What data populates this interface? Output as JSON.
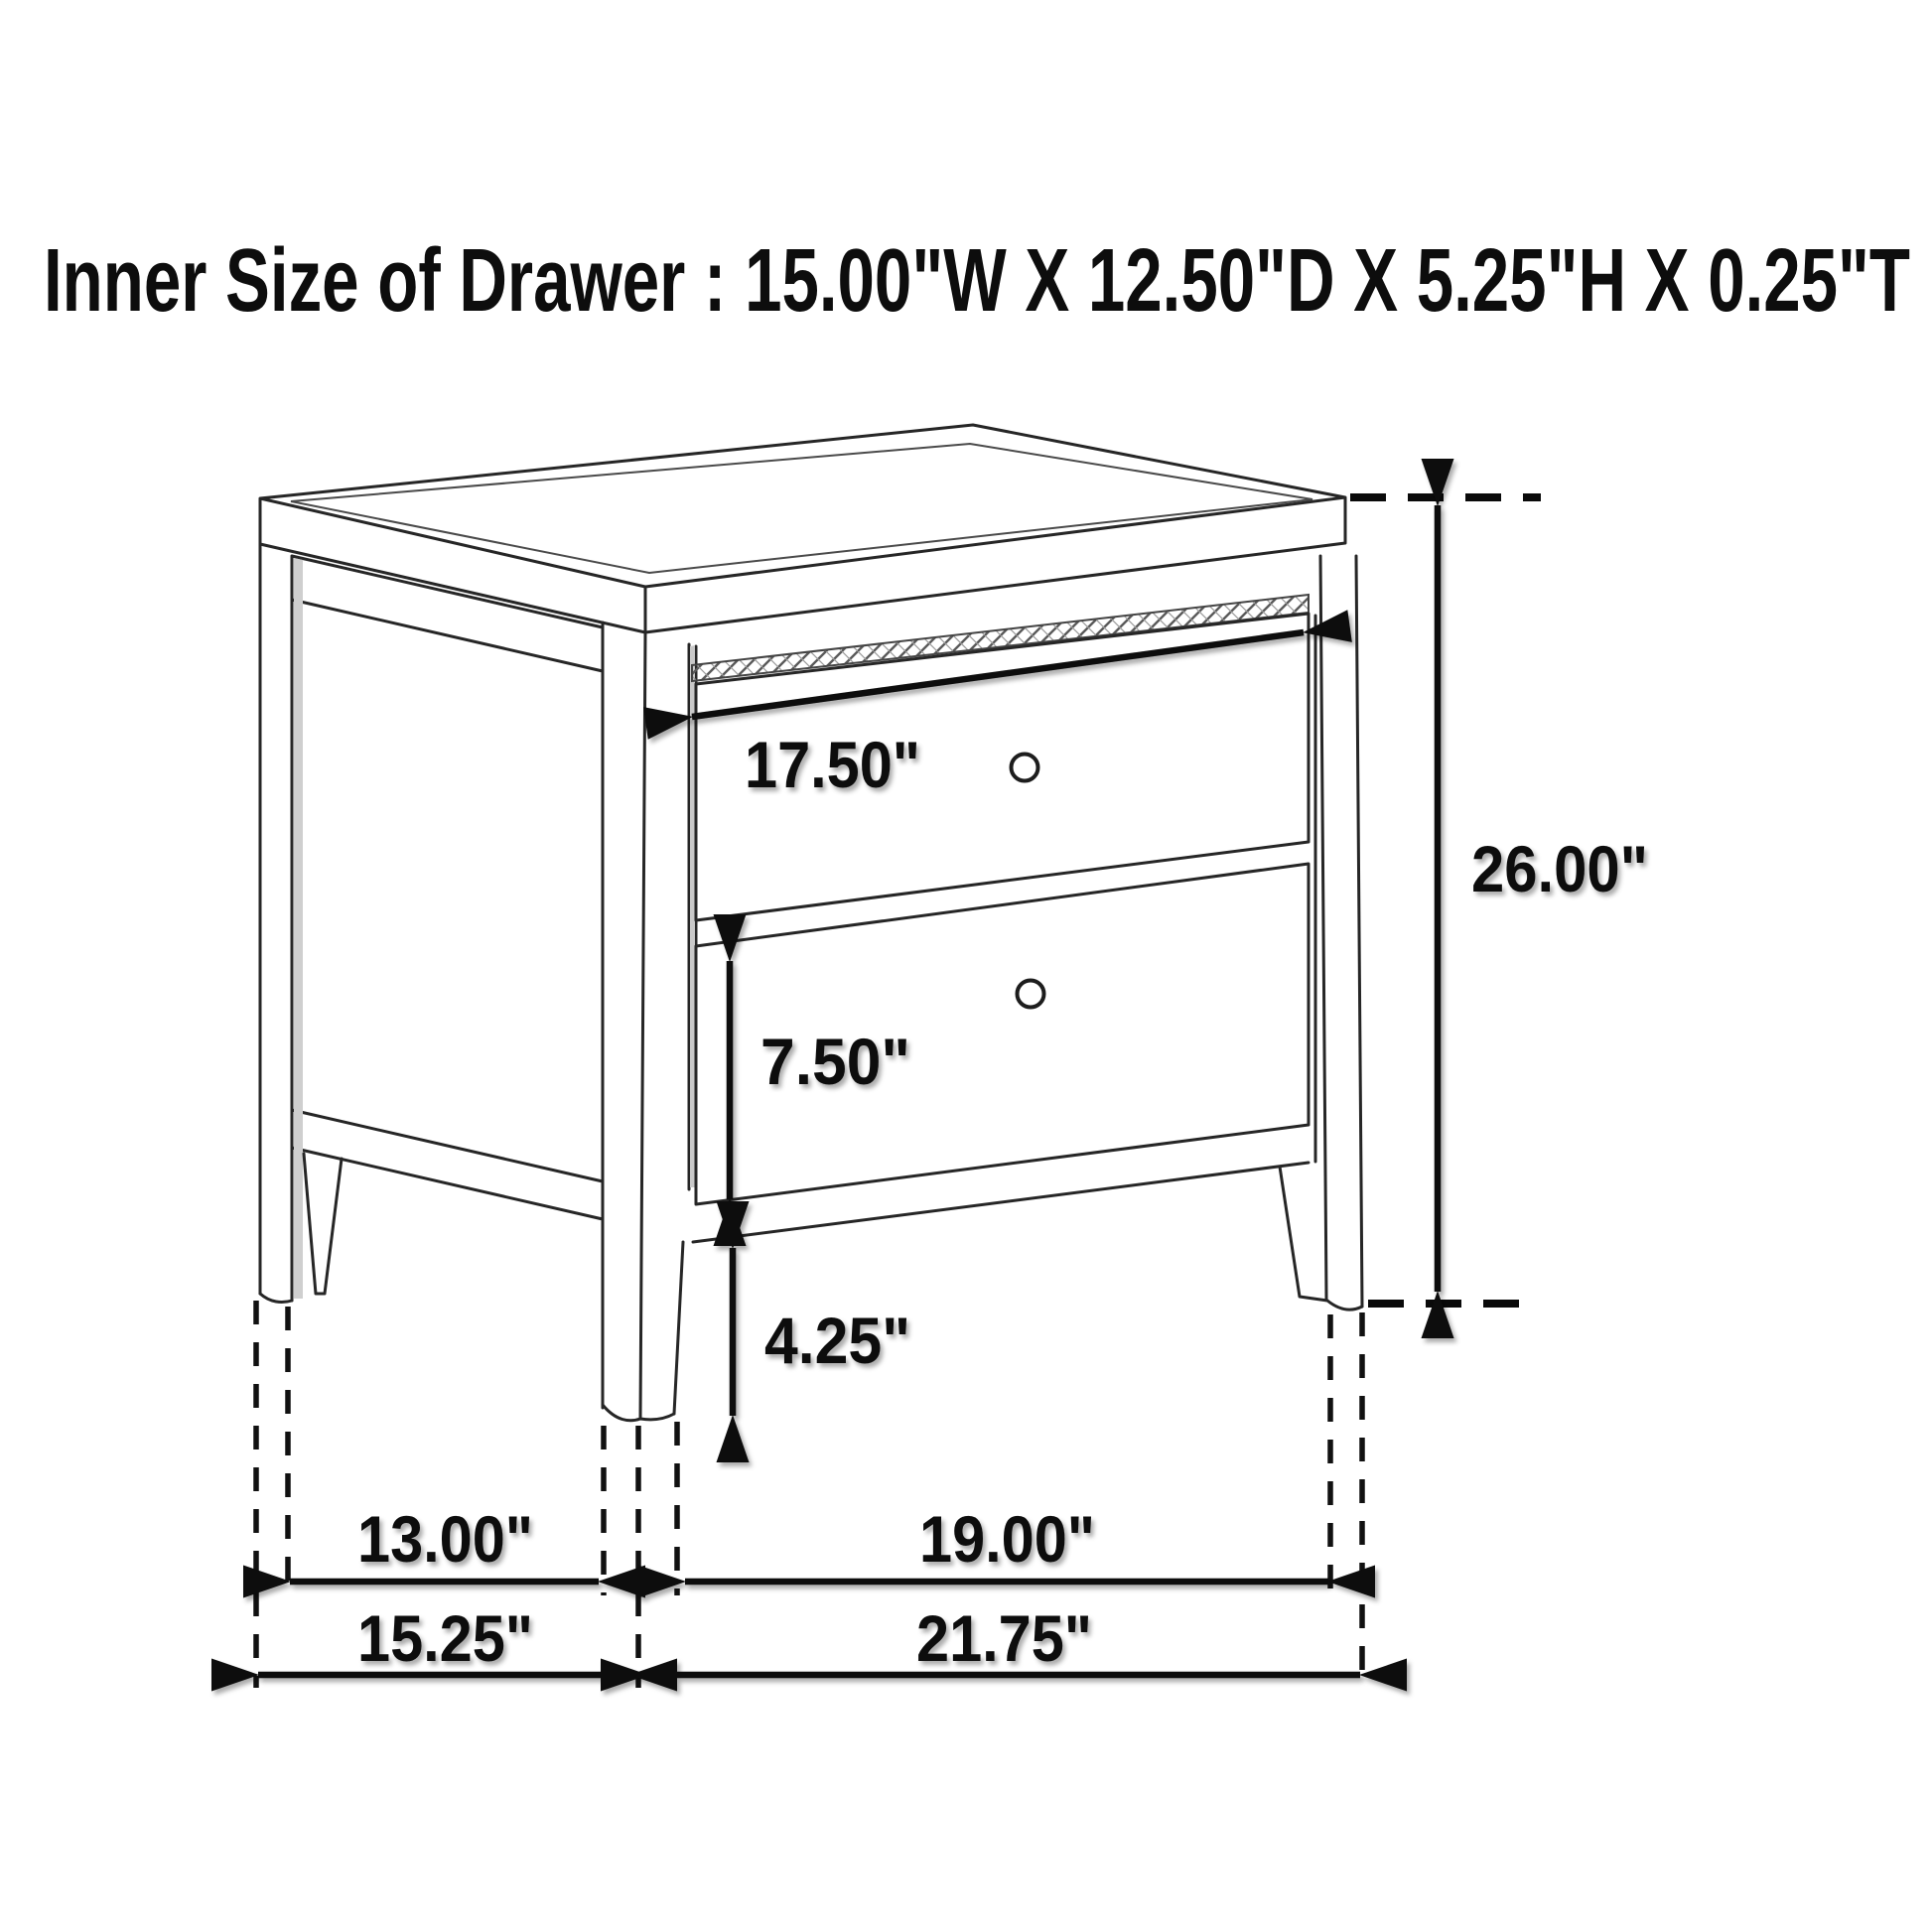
{
  "title": {
    "text": "Inner Size of Drawer : 15.00\"W X 12.50\"D X 5.25\"H X 0.25\"T"
  },
  "inner_drawer_size": {
    "width": "15.00\"",
    "depth": "12.50\"",
    "height": "5.25\"",
    "thickness": "0.25\""
  },
  "figure": {
    "subject": "two-drawer nightstand",
    "view": "isometric line drawing",
    "drawer_count": 2,
    "knob_count": 2
  },
  "dimensions": {
    "drawer_front_width": {
      "label": "17.50\"",
      "value_in": 17.5
    },
    "overall_height": {
      "label": "26.00\"",
      "value_in": 26.0
    },
    "drawer_front_height": {
      "label": "7.50\"",
      "value_in": 7.5
    },
    "leg_height": {
      "label": "4.25\"",
      "value_in": 4.25
    },
    "side_leg_spacing": {
      "label": "13.00\"",
      "value_in": 13.0
    },
    "overall_depth": {
      "label": "15.25\"",
      "value_in": 15.25
    },
    "front_leg_spacing": {
      "label": "19.00\"",
      "value_in": 19.0
    },
    "overall_width": {
      "label": "21.75\"",
      "value_in": 21.75
    }
  },
  "colors": {
    "background": "#ffffff",
    "line": "#262626",
    "annotation": "#0d0d0d"
  }
}
